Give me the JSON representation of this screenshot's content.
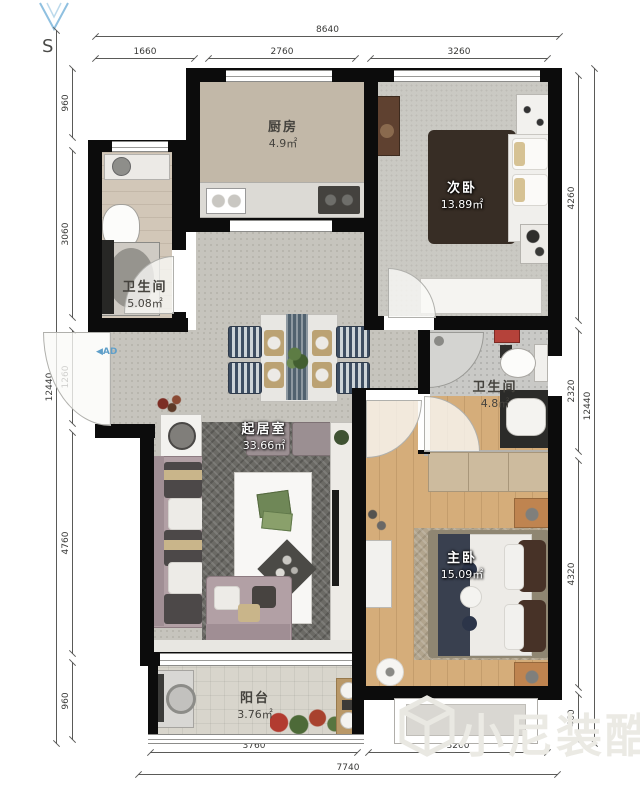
{
  "compass": {
    "label": "S"
  },
  "entry_marker": {
    "label": "◀AD"
  },
  "rooms": {
    "kitchen": {
      "name": "厨房",
      "area": "4.9㎡"
    },
    "bathroom_main": {
      "name": "卫生间",
      "area": "5.08㎡"
    },
    "second_bedroom": {
      "name": "次卧",
      "area": "13.89㎡"
    },
    "bathroom_ensuite": {
      "name": "卫生间",
      "area": "4.8㎡"
    },
    "living_room": {
      "name": "起居室",
      "area": "33.66㎡"
    },
    "master_bedroom": {
      "name": "主卧",
      "area": "15.09㎡"
    },
    "balcony": {
      "name": "阳台",
      "area": "3.76㎡"
    }
  },
  "dimensions": {
    "top": {
      "total": "8640",
      "segments": [
        "1660",
        "2760",
        "3260"
      ]
    },
    "bottom": {
      "total": "7740",
      "segments": [
        "3760",
        "3260"
      ]
    },
    "left": {
      "total": "12440",
      "segments": [
        "960",
        "3060",
        "1260",
        "4760",
        "960"
      ]
    },
    "right": {
      "total": "12440",
      "segments": [
        "4260",
        "2320",
        "4320",
        "460"
      ]
    }
  },
  "watermark": {
    "text": "小尼装酷"
  },
  "colors": {
    "wall": "#0c0c0c",
    "wood_floor": "#d5ad7a",
    "compass_blue": "#8fc0e0",
    "marker_blue": "#5f9fc9"
  }
}
